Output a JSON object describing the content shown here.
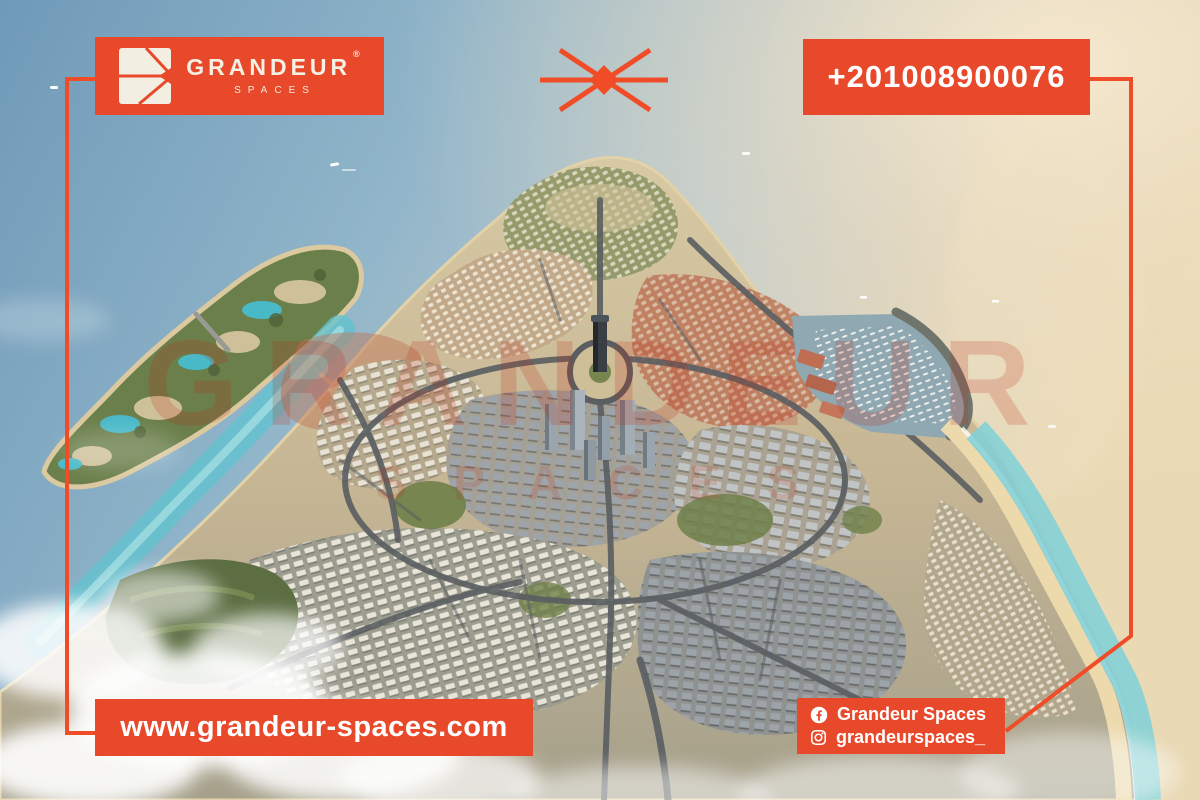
{
  "brand": {
    "name": "GRANDEUR",
    "subtitle": "SPACES",
    "registered_mark": "®",
    "accent_color": "#E8492B",
    "frame_color": "#F04C27",
    "logo_text_color": "#F5F0E4"
  },
  "header": {
    "phone": "+201008900076"
  },
  "footer": {
    "website": "www.grandeur-spaces.com",
    "social": [
      {
        "network": "facebook",
        "icon": "facebook-circle-icon",
        "handle": "Grandeur Spaces"
      },
      {
        "network": "instagram",
        "icon": "instagram-outline-icon",
        "handle": "grandeurspaces_"
      }
    ]
  },
  "watermark": {
    "line1": "GRANDEUR",
    "line2": "SPACES"
  },
  "icons": {
    "logo_mark": "split-square-arrow-icon",
    "center_divider": "x-star-divider-icon"
  },
  "render_palette": {
    "sea": "#7FA6C0",
    "sun_glare": "#F2E4C4",
    "sand": "#C9BA97",
    "city_blocks": "#AEB4B8",
    "greenery": "#6B7F4B",
    "lagoon_water": "#5FC3CF",
    "terracotta": "#BD7A5C",
    "cloud": "#FFFFFF"
  }
}
